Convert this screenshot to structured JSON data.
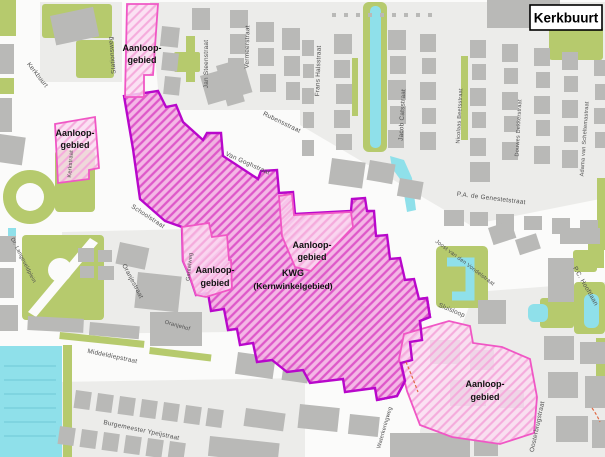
{
  "map_title": "Kerkbuurt",
  "zone_labels": {
    "aanloop_line1": "Aanloop-",
    "aanloop_line2": "gebied",
    "kwg_line1": "KWG",
    "kwg_line2": "(Kernwinkelgebied)"
  },
  "streets": {
    "stationsweg": "Stationsweg",
    "kerkbuurt_street": "Kerkbuurt",
    "jan_steenstraat": "Jan Steenstraat",
    "vermeerstraat": "Vermeerstraat",
    "frans_halsstraat": "Frans Halsstraat",
    "rubensstraat": "Rubensstraat",
    "van_goghstraat": "Van Goghstraat",
    "jacob_catsstraat": "Jacob Catsstraat",
    "nicolaas_beetsstraat": "Nicolaas Beetsstraat",
    "douwes_dekkerstraat": "Douwes Dekkerstraat",
    "adama_van_scheltemastraat": "Adama van Scheltemastraat",
    "pa_de_genestetstraat": "P.A. de Genestetstraat",
    "joost_van_den_vondelstraat": "Joost van den Vondelstraat",
    "pc_hooftlaan": "P.C. Hooftlaan",
    "oosterbrugstraat": "Oosterbrugstraat",
    "waterkeringweg": "Waterkeringweg",
    "sluisloop": "Sluisloop",
    "schoolstraat": "Schoolstraat",
    "gantelweg": "Gantelweg",
    "oranjestraat": "Oranjestraat",
    "oranjehof": "Oranjehof",
    "middeldiepstraat": "Middeldiepstraat",
    "burgemeester_ypeijstraat": "Burgemeester Ypeijstraat",
    "dr_langeveldplein": "Dr. Langeveldplein",
    "kerkstraat": "Kerkstraat"
  },
  "colors": {
    "background": "#fbfbfa",
    "parcel": "#ececea",
    "building": "#b9b9b7",
    "green": "#b6ca6d",
    "water": "#8fe0ea",
    "kwg_fill": "#f3b1e4",
    "kwg_hatch": "#de58c9",
    "kwg_border": "#b807cb",
    "aanloop_fill": "#fbdcf1",
    "aanloop_hatch": "#f5abdc",
    "aanloop_border": "#f057c5",
    "red_mark": "#e06a45",
    "street_label": "#4f4f4f",
    "zone_label": "#111111"
  }
}
